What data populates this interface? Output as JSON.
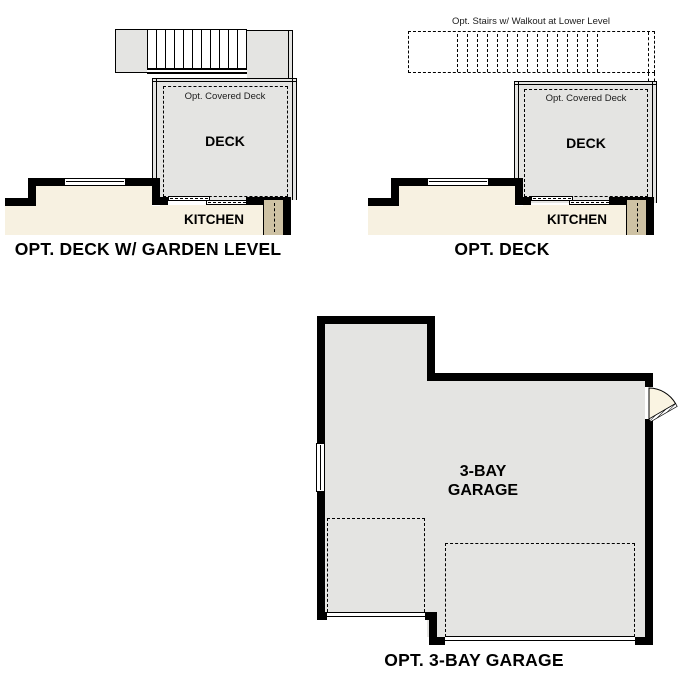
{
  "palette": {
    "wall": "#000000",
    "floor_gray": "#e4e4e2",
    "floor_cream": "#f7f1e1",
    "floor_tan": "#cec2a4",
    "door_cream": "#faf4e2"
  },
  "plans": {
    "deck_garden": {
      "title": "OPT. DECK W/ GARDEN LEVEL",
      "covered_deck_label": "Opt. Covered Deck",
      "deck_label": "DECK",
      "kitchen_label": "KITCHEN"
    },
    "deck": {
      "title": "OPT. DECK",
      "stairs_label": "Opt. Stairs w/ Walkout at Lower Level",
      "covered_deck_label": "Opt. Covered Deck",
      "deck_label": "DECK",
      "kitchen_label": "KITCHEN"
    },
    "garage": {
      "title": "OPT. 3-BAY GARAGE",
      "room_label": "3-BAY\nGARAGE"
    }
  }
}
